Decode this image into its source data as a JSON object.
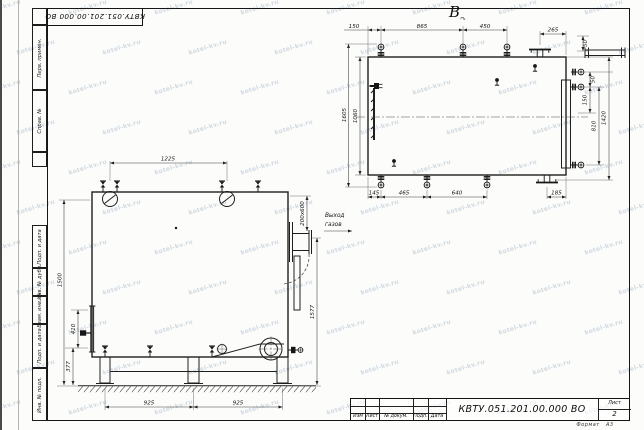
{
  "watermark": {
    "text": "kotel-kv.ru"
  },
  "sheet": {
    "top_stamp": "КВТУ.051.201.00.000  ВО",
    "format_note": "Формат   А3",
    "margin_labels": [
      "Перв. примен.",
      "Справ. №",
      "Подп. и дата",
      "Инв. № дубл.",
      "Взам. инв. №",
      "Подп. и дата",
      "Инв. № подл."
    ]
  },
  "title_block": {
    "headers": [
      "Изм",
      "Лист",
      "№ докум.",
      "Подп.",
      "Дата"
    ],
    "doc_number": "КВТУ.051.201.00.000  ВО",
    "sheet_label": "Лист",
    "sheet_number": "2"
  },
  "top_view": {
    "label": "В",
    "label_modifier": "↷",
    "dims_top": [
      "150",
      "865",
      "450",
      "265"
    ],
    "dims_right": [
      "50",
      "50",
      "150",
      "810",
      "1420"
    ],
    "dims_bottom": [
      "145",
      "465",
      "640",
      "185"
    ],
    "dims_left": [
      "1605",
      "1060"
    ]
  },
  "front_view": {
    "dim_top": "1225",
    "dims_left": [
      "1500",
      "410",
      "377"
    ],
    "dims_bottom": [
      "925",
      "925"
    ],
    "dim_right": "1577",
    "duct_dim": "200x600",
    "outlet_label": [
      "Выход",
      "газов"
    ]
  }
}
